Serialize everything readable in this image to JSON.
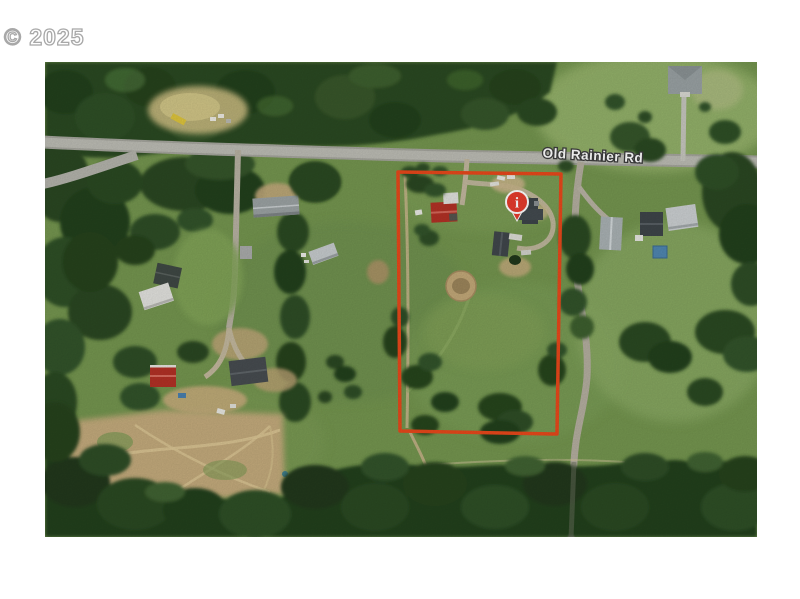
{
  "watermark": "© 2025",
  "map": {
    "road_label": "Old Rainier Rd",
    "marker_glyph": "i",
    "colors": {
      "boundary": "#e8481b",
      "marker": "#e63c2d",
      "road_label_fill": "#ffffff",
      "road_label_outline": "#3d3d3d"
    }
  }
}
